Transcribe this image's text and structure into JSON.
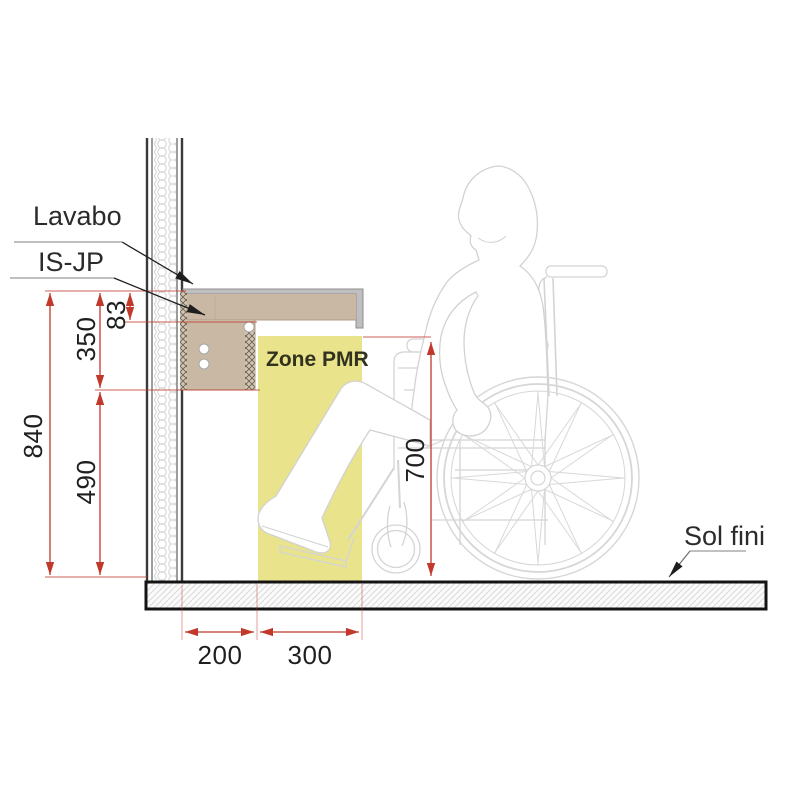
{
  "labels": {
    "lavabo": "Lavabo",
    "is_jp": "IS-JP",
    "zone_pmr": "Zone PMR",
    "sol_fini": "Sol fini"
  },
  "dimensions": {
    "total_height": "840",
    "upper_zone": "350",
    "knee_clearance": "490",
    "counter_thickness": "83",
    "free_height_under": "700",
    "wall_offset": "200",
    "pmr_zone_depth": "300"
  },
  "colors": {
    "dimension_red": "#c0392b",
    "zone_pmr_yellow": "#e9e48c",
    "counter_tan": "#c8b8a4",
    "silhouette_gray": "#d4d4d4"
  }
}
